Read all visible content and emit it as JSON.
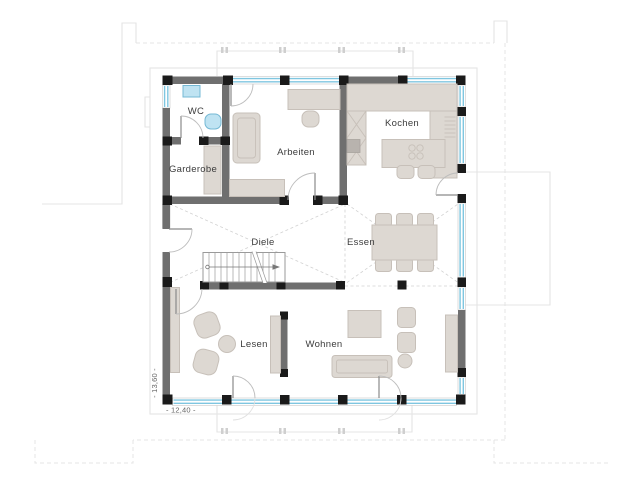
{
  "plan": {
    "type": "architectural-floor-plan",
    "rooms": {
      "wc": "WC",
      "garderobe": "Garderobe",
      "arbeiten": "Arbeiten",
      "kochen": "Kochen",
      "diele": "Diele",
      "essen": "Essen",
      "lesen": "Lesen",
      "wohnen": "Wohnen"
    },
    "dimensions": {
      "width": "- 12,40 -",
      "height": "- 13,60 -"
    }
  },
  "colors": {
    "background": "#ffffff",
    "wall": "#6f6f6f",
    "column": "#1a1a1a",
    "window_glass": "#7fc6e0",
    "furniture_fill": "#ddd8d2",
    "furniture_stroke": "#c7c0b9",
    "sanitary_fill": "#bfe3f2",
    "sanitary_stroke": "#74b8d4",
    "context_line": "#e4e4e4",
    "dashed_guide": "#d2d2d2",
    "label_text": "#3c3c3c"
  }
}
